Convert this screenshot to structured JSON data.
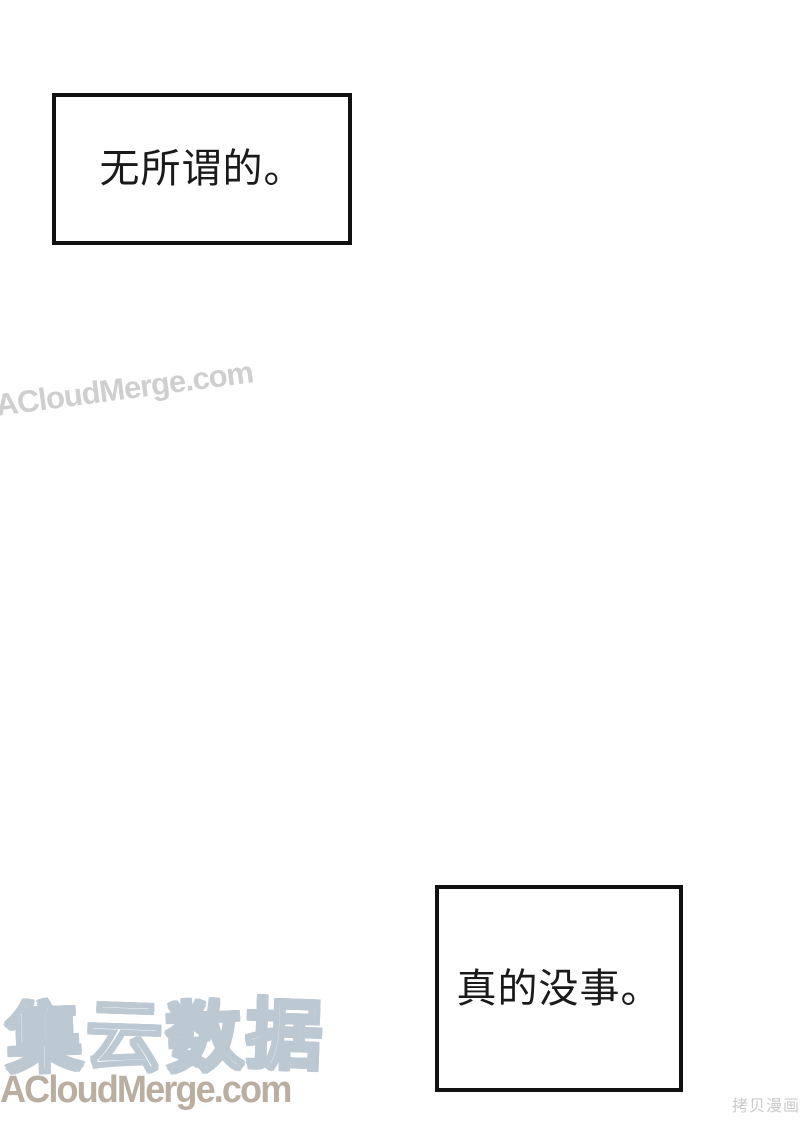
{
  "panels": {
    "box1": {
      "text": "无所谓的。"
    },
    "box2": {
      "text": "真的没事。"
    }
  },
  "watermarks": {
    "diagonal": "ACloudMerge.com",
    "logo_cn": "集云数据",
    "logo_cn_chars": [
      "集",
      "云",
      "数",
      "据"
    ],
    "site": "ACloudMerge.com",
    "corner": "拷贝漫画"
  },
  "colors": {
    "bg": "#ffffff",
    "box-border": "#111111",
    "box-text": "#1a1a1a",
    "logo-outline": "#bcc9d3",
    "site-color": "#b9ae9f",
    "diag-color": "#cfcfcf",
    "corner-color": "#c6c6c6"
  }
}
